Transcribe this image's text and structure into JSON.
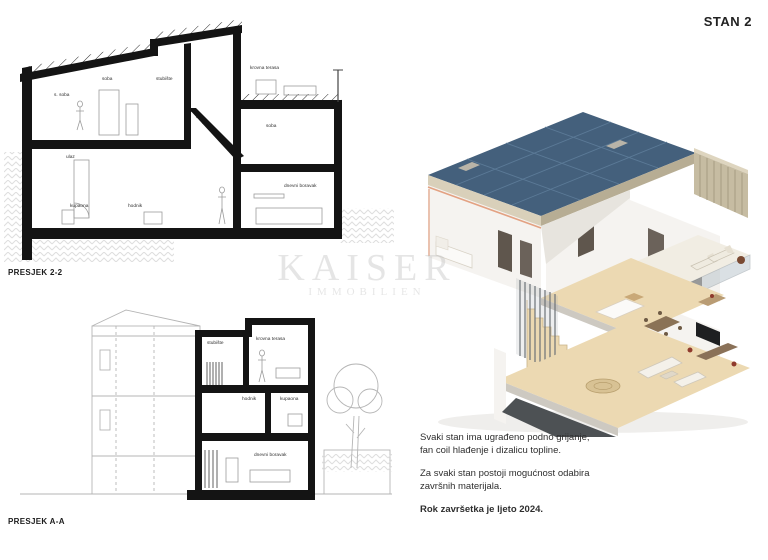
{
  "header": {
    "unit_label": "STAN 2"
  },
  "watermark": {
    "line1": "KAISER",
    "line2": "IMMOBILIEN"
  },
  "drawings": {
    "presjek22": {
      "caption": "PRESJEK 2-2",
      "rooms": {
        "upper_left": "s. soba",
        "upper_mid": "soba",
        "upper_right": "stubište",
        "roof_terrace": "krovna terasa",
        "entry": "ulaz",
        "mid_right_room": "soba",
        "lower_left": "kupaona",
        "lower_mid": "hodnik",
        "living": "dnevni boravak"
      }
    },
    "presjekAA": {
      "caption": "PRESJEK A-A",
      "rooms": {
        "top_left": "stubište",
        "top_right": "krovna terasa",
        "mid_left": "hodnik",
        "mid_right": "kupaona",
        "bottom": "dnevni boravak"
      }
    }
  },
  "render": {
    "kind": "3d-axonometric-cutaway",
    "colors": {
      "solar_panel": "#44607c",
      "solar_line": "#5e7d9a",
      "wood_floor": "#ecd9b2",
      "slats": "#c6bca2",
      "hedge": "#5e7a3e",
      "wall_white": "#f5f3f0",
      "wall_shade": "#e7e4de",
      "base_dark": "#4d5154",
      "accent_cut": "#e3a283",
      "door_dark": "#5f564d",
      "rail_grey": "#6d7277"
    }
  },
  "notes": {
    "p1_l1": "Svaki stan ima ugrađeno podno grijanje,",
    "p1_l2": "fan coil hlađenje i dizalicu topline.",
    "p2_l1": "Za svaki stan postoji mogućnost odabira",
    "p2_l2": "završnih materijala.",
    "p3": "Rok završetka je ljeto 2024."
  }
}
